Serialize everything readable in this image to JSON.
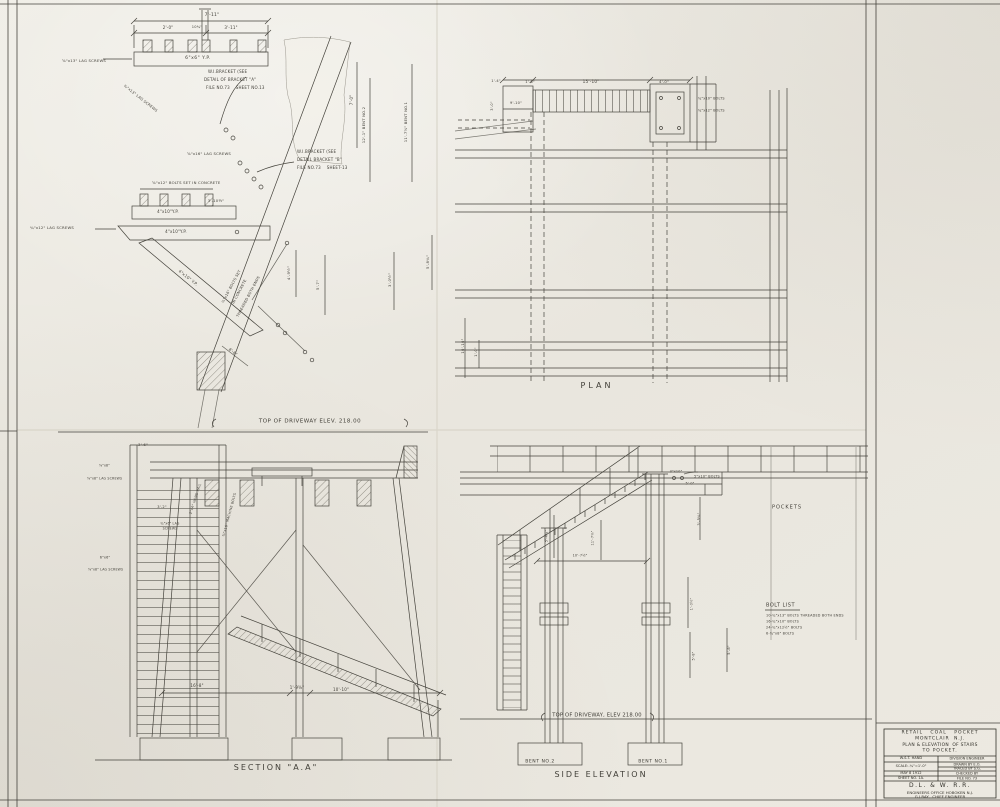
{
  "sheet": {
    "paper_color": "#ebe8e0",
    "line_color": "#45433c",
    "text_color": "#403e37"
  },
  "title_block": {
    "project": [
      "RETAIL   COAL   POCKET",
      "MONTCLAIR  N.J.",
      "PLAN & ELEVATION  OF STAIRS",
      "TO POCKET."
    ],
    "left_col": [
      "W.S.T. HAND",
      "SCALE:-¼\"=1'-0\"",
      "MAY 8 1912",
      "SHEET NO. 1A."
    ],
    "right_col": [
      "DIVISION ENGINEER",
      "DRAWN BY E.O.",
      "TRACED BY S.G.",
      "CHECKED BY",
      "FILE NO. 73"
    ],
    "railroad": "D.L. & W. R.R.",
    "office": "ENGINEERS OFFICE HOBOKEN N.J.",
    "chief_engineer": "G.J.RAY,  CHIEF ENGINEER"
  },
  "view_labels": {
    "plan": "PLAN",
    "section": "SECTION \"A.A\"",
    "side_elevation": "SIDE ELEVATION"
  },
  "annotations": [
    {
      "n": "dim",
      "t": "7'-11\"",
      "x": 212,
      "y": 16,
      "fs": 4.5
    },
    {
      "n": "dim",
      "t": "2'-0\"",
      "x": 168,
      "y": 28,
      "fs": 4
    },
    {
      "n": "dim",
      "t": "10¾\"",
      "x": 197,
      "y": 28,
      "fs": 3.6
    },
    {
      "n": "dim",
      "t": "3'-11\"",
      "x": 231,
      "y": 28,
      "fs": 4
    },
    {
      "n": "note",
      "t": "6\"x6\" Y.P.",
      "x": 198,
      "y": 59,
      "fs": 4.5,
      "ls": 0.5
    },
    {
      "n": "note",
      "t": "⅝\"x13\" LAG SCREWS",
      "x": 62,
      "y": 61,
      "fs": 3.8,
      "ta": "l"
    },
    {
      "n": "note",
      "t": "W.I.BRACKET (SEE",
      "x": 208,
      "y": 72,
      "fs": 4,
      "ta": "l"
    },
    {
      "n": "note",
      "t": "DETAIL OF BRACKET \"A\"",
      "x": 204,
      "y": 80,
      "fs": 4,
      "ta": "l"
    },
    {
      "n": "note",
      "t": "FILE NO.73    SHEET NO.13",
      "x": 206,
      "y": 88,
      "fs": 4,
      "ta": "l"
    },
    {
      "n": "note",
      "t": "¾\"x13\" LAG SCREWS",
      "x": 140,
      "y": 99,
      "fs": 3.6,
      "rot": 38
    },
    {
      "n": "dim",
      "t": "7'-0\"",
      "x": 352,
      "y": 100,
      "fs": 4,
      "rot": -90
    },
    {
      "n": "dim",
      "t": "12'-1\" BENT NO.2",
      "x": 364,
      "y": 125,
      "fs": 3.8,
      "rot": -90
    },
    {
      "n": "dim",
      "t": "11'-7⅝\" BENT NO.1",
      "x": 406,
      "y": 122,
      "fs": 3.8,
      "rot": -90
    },
    {
      "n": "note",
      "t": "⅝\"x16\" LAG SCREWS",
      "x": 187,
      "y": 154,
      "fs": 3.8,
      "ta": "l"
    },
    {
      "n": "note",
      "t": "W.I.BRACKET (SEE",
      "x": 297,
      "y": 152,
      "fs": 4,
      "ta": "l"
    },
    {
      "n": "note",
      "t": "DETAIL BRACKET \"B\"",
      "x": 297,
      "y": 160,
      "fs": 4,
      "ta": "l"
    },
    {
      "n": "note",
      "t": "FILE NO.73    SHEET-13",
      "x": 297,
      "y": 168,
      "fs": 4,
      "ta": "l"
    },
    {
      "n": "note",
      "t": "⅝\"x12\" BOLTS SET IN CONCRETE",
      "x": 152,
      "y": 183,
      "fs": 3.8,
      "ta": "l"
    },
    {
      "n": "dim",
      "t": "3'-10½\"",
      "x": 216,
      "y": 201,
      "fs": 3.8
    },
    {
      "n": "note",
      "t": "4\"x10\"Y.P.",
      "x": 168,
      "y": 212,
      "fs": 4
    },
    {
      "n": "note",
      "t": "¾\"x12\" LAG SCREWS",
      "x": 30,
      "y": 228,
      "fs": 3.8,
      "ta": "l"
    },
    {
      "n": "note",
      "t": "4\"x10\"Y.P.",
      "x": 176,
      "y": 232,
      "fs": 4
    },
    {
      "n": "note",
      "t": "4\"x10\" Y.P.",
      "x": 188,
      "y": 278,
      "fs": 4,
      "rot": 38
    },
    {
      "n": "note",
      "t": "½\"x16\" BOLTS SET",
      "x": 232,
      "y": 287,
      "fs": 3.6,
      "rot": -62
    },
    {
      "n": "note",
      "t": "IN CONCRETE",
      "x": 240,
      "y": 292,
      "fs": 3.6,
      "rot": -62
    },
    {
      "n": "note",
      "t": "THREADED BOTH ENDS",
      "x": 249,
      "y": 297,
      "fs": 3.6,
      "rot": -62
    },
    {
      "n": "dim",
      "t": "4'-9½\"",
      "x": 289,
      "y": 273,
      "fs": 3.8,
      "rot": -90
    },
    {
      "n": "dim",
      "t": "5'-7\"",
      "x": 318,
      "y": 285,
      "fs": 3.8,
      "rot": -90
    },
    {
      "n": "dim",
      "t": "5'-8¾\"",
      "x": 428,
      "y": 262,
      "fs": 3.8,
      "rot": -90
    },
    {
      "n": "dim",
      "t": "3'-0½\"",
      "x": 390,
      "y": 280,
      "fs": 3.8,
      "rot": -90
    },
    {
      "n": "dim",
      "t": "8'-6\"",
      "x": 233,
      "y": 352,
      "fs": 3.8,
      "rot": 38
    },
    {
      "n": "driveway-elevation-label",
      "t": "TOP OF DRIVEWAY ELEV. 218.00",
      "x": 310,
      "y": 422,
      "fs": 5.5,
      "ls": 0.5
    },
    {
      "n": "dim",
      "t": "1'-4\"",
      "x": 496,
      "y": 82,
      "fs": 3.6
    },
    {
      "n": "dim",
      "t": "1'-6\"",
      "x": 530,
      "y": 83,
      "fs": 3.6
    },
    {
      "n": "dim",
      "t": "15'-10\"",
      "x": 591,
      "y": 82,
      "fs": 4.2
    },
    {
      "n": "dim",
      "t": "4'-0\"",
      "x": 664,
      "y": 82,
      "fs": 3.8
    },
    {
      "n": "dim",
      "t": "9'-10\"",
      "x": 516,
      "y": 104,
      "fs": 3.6
    },
    {
      "n": "dim",
      "t": "3'-0\"",
      "x": 493,
      "y": 106,
      "fs": 3.6,
      "rot": -90
    },
    {
      "n": "note",
      "t": "¾\"x10\" BOLTS",
      "x": 698,
      "y": 99,
      "fs": 3.4,
      "ta": "l"
    },
    {
      "n": "note",
      "t": "¾\"x12\" BOLTS",
      "x": 698,
      "y": 111,
      "fs": 3.4,
      "ta": "l"
    },
    {
      "n": "dim",
      "t": "10'-10\"",
      "x": 463,
      "y": 346,
      "fs": 3.8,
      "rot": -90
    },
    {
      "n": "dim",
      "t": "1'-0\"",
      "x": 477,
      "y": 352,
      "fs": 3.6,
      "rot": -90
    },
    {
      "n": "plan-label",
      "t": "PLAN",
      "x": 597,
      "y": 386,
      "fs": 8,
      "ls": 3
    },
    {
      "n": "dim",
      "t": "3'-6\"",
      "x": 143,
      "y": 445,
      "fs": 3.8
    },
    {
      "n": "note",
      "t": "⅝\"x8\"",
      "x": 99,
      "y": 466,
      "fs": 3.2,
      "ta": "l"
    },
    {
      "n": "note",
      "t": "⅝\"x8\" LAG SCREWS",
      "x": 87,
      "y": 479,
      "fs": 3.2,
      "ta": "l"
    },
    {
      "n": "dim",
      "t": "3'-2\"",
      "x": 162,
      "y": 508,
      "fs": 3.6
    },
    {
      "n": "note",
      "t": "2\"x4\" HAND RAIL",
      "x": 196,
      "y": 499,
      "fs": 3.4,
      "rot": -72
    },
    {
      "n": "note",
      "t": "¾\"x6\" LAG",
      "x": 170,
      "y": 524,
      "fs": 3.2
    },
    {
      "n": "note",
      "t": "SCREWS",
      "x": 170,
      "y": 529,
      "fs": 3.2
    },
    {
      "n": "note",
      "t": "¾\"x16\" MACHINE BOLTS",
      "x": 230,
      "y": 515,
      "fs": 3.4,
      "rot": -75
    },
    {
      "n": "note",
      "t": "6\"x6\"",
      "x": 105,
      "y": 558,
      "fs": 3.4
    },
    {
      "n": "note",
      "t": "⅝\"x8\" LAG SCREWS",
      "x": 88,
      "y": 570,
      "fs": 3.2,
      "ta": "l"
    },
    {
      "n": "dim",
      "t": "16'-8\"",
      "x": 197,
      "y": 686,
      "fs": 4
    },
    {
      "n": "dim",
      "t": "1'-9⅝\"",
      "x": 297,
      "y": 688,
      "fs": 4
    },
    {
      "n": "dim",
      "t": "10'-10\"",
      "x": 341,
      "y": 690,
      "fs": 4
    },
    {
      "n": "section-label",
      "t": "SECTION \"A.A\"",
      "x": 276,
      "y": 768,
      "fs": 8,
      "ls": 2
    },
    {
      "n": "note",
      "t": "3\"x10\"",
      "x": 676,
      "y": 472,
      "fs": 3.4
    },
    {
      "n": "note",
      "t": "5\"x10\" BOLTS",
      "x": 707,
      "y": 477,
      "fs": 3.4
    },
    {
      "n": "dim",
      "t": "5'-0\"",
      "x": 690,
      "y": 484,
      "fs": 3.4
    },
    {
      "n": "dim",
      "t": "3'-5¾\"",
      "x": 700,
      "y": 519,
      "fs": 3.6,
      "rot": -90
    },
    {
      "n": "dim",
      "t": "5'-4¾\"",
      "x": 547,
      "y": 536,
      "fs": 3.4,
      "rot": -90
    },
    {
      "n": "dim",
      "t": "11'-7⅝\"",
      "x": 593,
      "y": 538,
      "fs": 3.4,
      "rot": -90
    },
    {
      "n": "dim",
      "t": "10'-7½\"",
      "x": 580,
      "y": 556,
      "fs": 3.4
    },
    {
      "n": "dim",
      "t": "1'-0½\"",
      "x": 692,
      "y": 604,
      "fs": 3.4,
      "rot": -90
    },
    {
      "n": "dim",
      "t": "5'-8\"",
      "x": 694,
      "y": 656,
      "fs": 3.4,
      "rot": -90
    },
    {
      "n": "dim",
      "t": "5'-8\"",
      "x": 730,
      "y": 650,
      "fs": 3.6,
      "rot": -90
    },
    {
      "n": "pockets-label",
      "t": "POCKETS",
      "x": 787,
      "y": 508,
      "fs": 5,
      "ls": 1
    },
    {
      "n": "bolt-list-title",
      "t": "BOLT LIST",
      "x": 766,
      "y": 606,
      "fs": 5,
      "ta": "l",
      "ls": 0.5
    },
    {
      "n": "bolt-list-item",
      "t": "10-¾\"x13\" BOLTS THREADED BOTH ENDS",
      "x": 766,
      "y": 616,
      "fs": 3.4,
      "ta": "l"
    },
    {
      "n": "bolt-list-item",
      "t": "16-¾\"x10\" BOLTS",
      "x": 766,
      "y": 622,
      "fs": 3.4,
      "ta": "l"
    },
    {
      "n": "bolt-list-item",
      "t": "24-¾\"x12½\" BOLTS",
      "x": 766,
      "y": 628,
      "fs": 3.4,
      "ta": "l"
    },
    {
      "n": "bolt-list-item",
      "t": "6-¾\"x8\" BOLTS",
      "x": 766,
      "y": 634,
      "fs": 3.4,
      "ta": "l"
    },
    {
      "n": "driveway-elevation-label",
      "t": "TOP OF DRIVEWAY, ELEV 218.00",
      "x": 597,
      "y": 716,
      "fs": 5.2
    },
    {
      "n": "bent-no2-label",
      "t": "BENT NO.2",
      "x": 540,
      "y": 763,
      "fs": 4.6,
      "ls": 0.5
    },
    {
      "n": "bent-no1-label",
      "t": "BENT NO.1",
      "x": 653,
      "y": 763,
      "fs": 4.6,
      "ls": 0.5
    },
    {
      "n": "side-elevation-label",
      "t": "SIDE ELEVATION",
      "x": 601,
      "y": 775,
      "fs": 8,
      "ls": 2
    }
  ]
}
